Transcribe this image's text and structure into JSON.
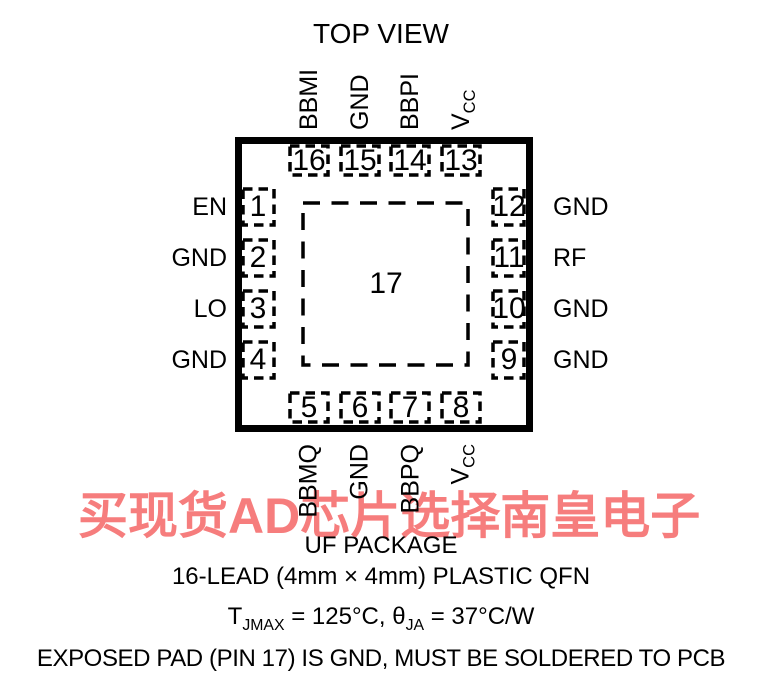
{
  "title": "TOP VIEW",
  "pins": {
    "top": [
      {
        "number": "16",
        "label": "BBMI"
      },
      {
        "number": "15",
        "label": "GND"
      },
      {
        "number": "14",
        "label": "BBPI"
      },
      {
        "number": "13",
        "label_main": "V",
        "label_sub": "CC"
      }
    ],
    "bottom": [
      {
        "number": "5",
        "label": "BBMQ"
      },
      {
        "number": "6",
        "label": "GND"
      },
      {
        "number": "7",
        "label": "BBPQ"
      },
      {
        "number": "8",
        "label_main": "V",
        "label_sub": "CC"
      }
    ],
    "left": [
      {
        "number": "1",
        "label": "EN"
      },
      {
        "number": "2",
        "label": "GND"
      },
      {
        "number": "3",
        "label": "LO"
      },
      {
        "number": "4",
        "label": "GND"
      }
    ],
    "right": [
      {
        "number": "12",
        "label": "GND"
      },
      {
        "number": "11",
        "label": "RF"
      },
      {
        "number": "10",
        "label": "GND"
      },
      {
        "number": "9",
        "label": "GND"
      }
    ],
    "center": {
      "number": "17"
    }
  },
  "captions": {
    "package_name": "UF PACKAGE",
    "lead_line": "16-LEAD (4mm × 4mm) PLASTIC QFN",
    "thermal": {
      "t": "T",
      "t_sub": "JMAX",
      "mid": " = 125°C, θ",
      "theta_sub": "JA",
      "tail": " = 37°C/W"
    },
    "exposed_pad": "EXPOSED PAD (PIN 17) IS GND, MUST BE SOLDERED TO PCB"
  },
  "watermark": {
    "text": "买现货AD芯片选择南皇电子",
    "color": "#f67d7d"
  }
}
